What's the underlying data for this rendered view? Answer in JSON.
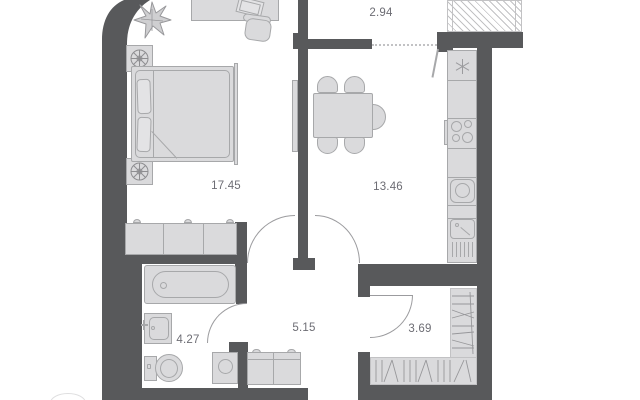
{
  "rooms": {
    "bedroom": {
      "area": "17.45"
    },
    "kitchen_living": {
      "area": "13.46"
    },
    "balcony": {
      "area": "2.94"
    },
    "hallway": {
      "area": "5.15"
    },
    "bathroom": {
      "area": "4.27"
    },
    "wardrobe_room": {
      "area": "3.69"
    }
  },
  "colors": {
    "wall": "#58595b",
    "ffill": "#dadadc",
    "fstroke": "#a7a8aa",
    "label": "#6d6d74",
    "line": "#9b9b9e",
    "hatch": "#c2c2c4",
    "light": "#e3e3e5"
  }
}
